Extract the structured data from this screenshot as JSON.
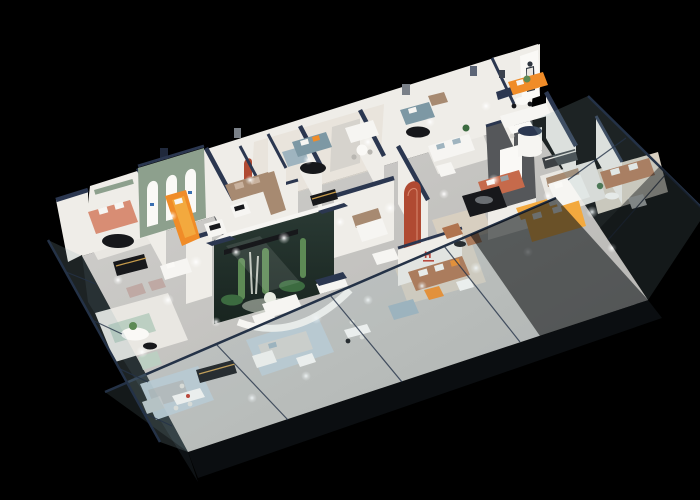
{
  "scene": {
    "title": "Isometric 3D cutaway render of a furniture showroom floor plan on a black background",
    "type": "3d-floorplan-render",
    "rooms": "multiple open showroom bays divided by white partitions with navy wall caps",
    "notable_features": [
      "sage arch wall with three white arches",
      "glass terrarium with cacti",
      "terracotta arch inlay panel",
      "charcoal media feature wall",
      "tilted glass perimeter facades",
      "woman standee poster",
      "ceiling spotlight pools on floor"
    ]
  },
  "logos": {
    "brand_initial": "H"
  },
  "icons": {
    "standee": "woman-standee",
    "signs": [
      "green-brand-strip-sign",
      "arch-brand-marks",
      "h-brand-logo"
    ]
  },
  "palette": {
    "bg": "#000000",
    "floor": "#c7c6c3",
    "floorDark": "#a9a8a5",
    "rugWhite": "#e9e7e2",
    "rugBlue": "#bfcdd6",
    "rugBeige": "#d8cfc0",
    "rugDark": "#5a5d60",
    "wall": "#efede8",
    "wallShade": "#d6d3cd",
    "wallBeige": "#e3ddd2",
    "cap": "#2b3750",
    "glassTint": "#8fb0b5",
    "glassDark": "#0e1215",
    "glassLine": "#243247",
    "sage": "#8da08d",
    "archRed": "#b04a32",
    "charcoal": "#55575a",
    "orange": "#f08c28",
    "amber": "#f3a93e",
    "caramel": "#b0744f",
    "terracotta": "#c66a4b",
    "salmon": "#d88d74",
    "mint": "#bccfc2",
    "teal": "#7d98a4",
    "bluegray": "#9fb4bf",
    "taupe": "#a78a71",
    "white": "#f6f5f2",
    "offwhite": "#faf9f6",
    "black": "#17181b",
    "gold": "#c79b4b",
    "plant": "#5d8a55",
    "plantDark": "#3c6b40",
    "logoRed": "#c0392b",
    "figure": "#2f3640"
  }
}
